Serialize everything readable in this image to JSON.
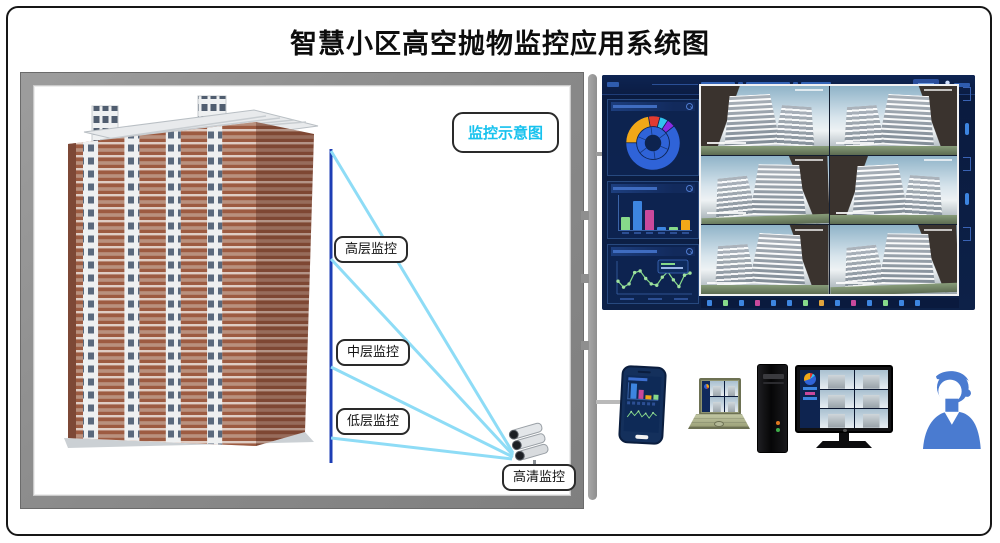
{
  "title": "智慧小区高空抛物监控应用系统图",
  "schematic": {
    "badge_label": "监控示意图",
    "beam_labels": [
      {
        "key": "high",
        "label": "高层监控"
      },
      {
        "key": "mid",
        "label": "中层监控"
      },
      {
        "key": "low",
        "label": "低层监控"
      }
    ],
    "camera_label": "高清监控"
  },
  "colors": {
    "accent_cyan": "#17c2ee",
    "beam_cyan": "#8edcf6",
    "pole_blue": "#1d3eb5",
    "frame_gray": "#8f8f8f",
    "connector_gray": "#9b9b9b",
    "dashboard_bg": "#0b1c42",
    "panel_border": "#27497f",
    "avatar_blue": "#4a7bd0"
  },
  "dashboard": {
    "ring_chart": {
      "segments": [
        {
          "color": "#e23b30",
          "value": 7
        },
        {
          "color": "#31c3ee",
          "value": 5
        },
        {
          "color": "#8a2be2",
          "value": 5
        },
        {
          "color": "#2f63d8",
          "value": 61
        },
        {
          "color": "#f2a818",
          "value": 22
        }
      ],
      "inner_color": "#2f63d8"
    },
    "bar_chart": {
      "bars": [
        {
          "color": "#86d98a",
          "value": 38
        },
        {
          "color": "#3d85e0",
          "value": 82
        },
        {
          "color": "#c9499c",
          "value": 58
        },
        {
          "color": "#3d85e0",
          "value": 8
        },
        {
          "color": "#86d98a",
          "value": 10
        },
        {
          "color": "#f2a818",
          "value": 30
        }
      ]
    },
    "line_chart": {
      "points": [
        40,
        18,
        30,
        72,
        78,
        50,
        30,
        25,
        55,
        75,
        45,
        20,
        62,
        70
      ],
      "color": "#86d98a"
    },
    "camera_feed_count": 6,
    "toolbar_colors": [
      "#3d85e0",
      "#86d98a",
      "#3d85e0",
      "#c9499c",
      "#3d85e0",
      "#3d85e0",
      "#86d98a",
      "#e0a43d",
      "#3d85e0",
      "#c9499c",
      "#3d85e0",
      "#86d98a",
      "#3d85e0",
      "#3d85e0"
    ]
  }
}
